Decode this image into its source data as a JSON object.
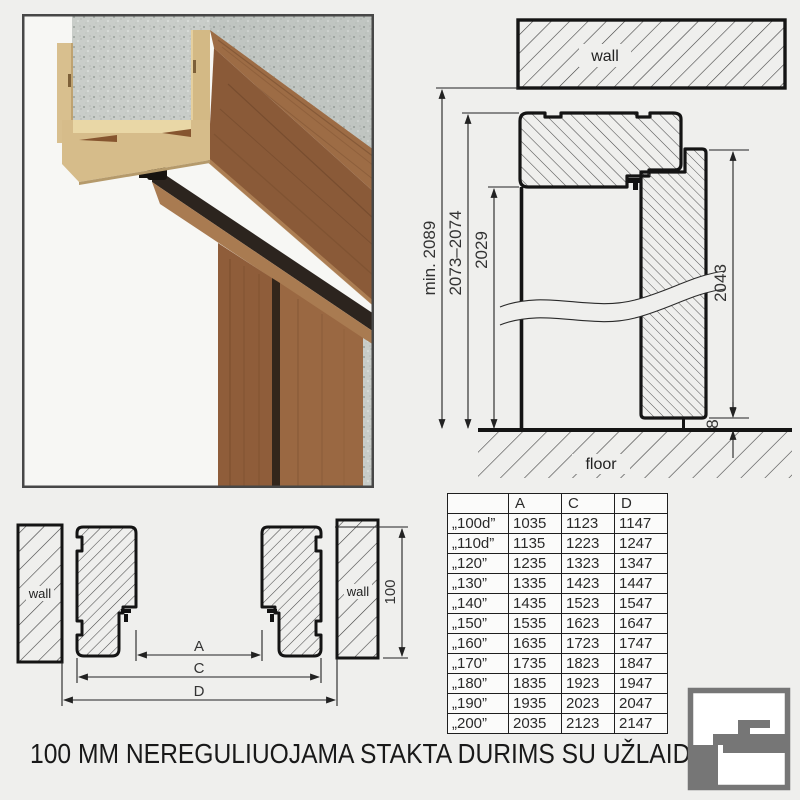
{
  "page": {
    "title": "100 MM NEREGULIUOJAMA STAKTA DURIMS SU UŽLAIDA"
  },
  "vertical_section": {
    "wall_label": "wall",
    "floor_label": "floor",
    "dim_total_height": "min. 2089",
    "dim_frame_outer_height": "2073–2074",
    "dim_clear_opening_height": "2029",
    "dim_door_height": "2043",
    "dim_floor_gap": "8"
  },
  "horizontal_section": {
    "wall_label_left": "wall",
    "wall_label_right": "wall",
    "dim_a_label": "A",
    "dim_c_label": "C",
    "dim_d_label": "D",
    "dim_frame_depth": "100"
  },
  "size_table": {
    "col_headers": [
      "A",
      "C",
      "D"
    ],
    "rows": [
      {
        "name": "„100d”",
        "A": "1035",
        "C": "1123",
        "D": "1147"
      },
      {
        "name": "„110d”",
        "A": "1135",
        "C": "1223",
        "D": "1247"
      },
      {
        "name": "„120”",
        "A": "1235",
        "C": "1323",
        "D": "1347"
      },
      {
        "name": "„130”",
        "A": "1335",
        "C": "1423",
        "D": "1447"
      },
      {
        "name": "„140”",
        "A": "1435",
        "C": "1523",
        "D": "1547"
      },
      {
        "name": "„150”",
        "A": "1535",
        "C": "1623",
        "D": "1647"
      },
      {
        "name": "„160”",
        "A": "1635",
        "C": "1723",
        "D": "1747"
      },
      {
        "name": "„170”",
        "A": "1735",
        "C": "1823",
        "D": "1847"
      },
      {
        "name": "„180”",
        "A": "1835",
        "C": "1923",
        "D": "1947"
      },
      {
        "name": "„190”",
        "A": "1935",
        "C": "2023",
        "D": "2047"
      },
      {
        "name": "„200”",
        "A": "2035",
        "C": "2123",
        "D": "2147"
      }
    ]
  },
  "colors": {
    "logo_gray": "#767676",
    "line": "#1a1a1a",
    "wood_front": "#8a5a38",
    "mdf_tan": "#d6bc8a",
    "concrete": "#c9cdc9"
  }
}
